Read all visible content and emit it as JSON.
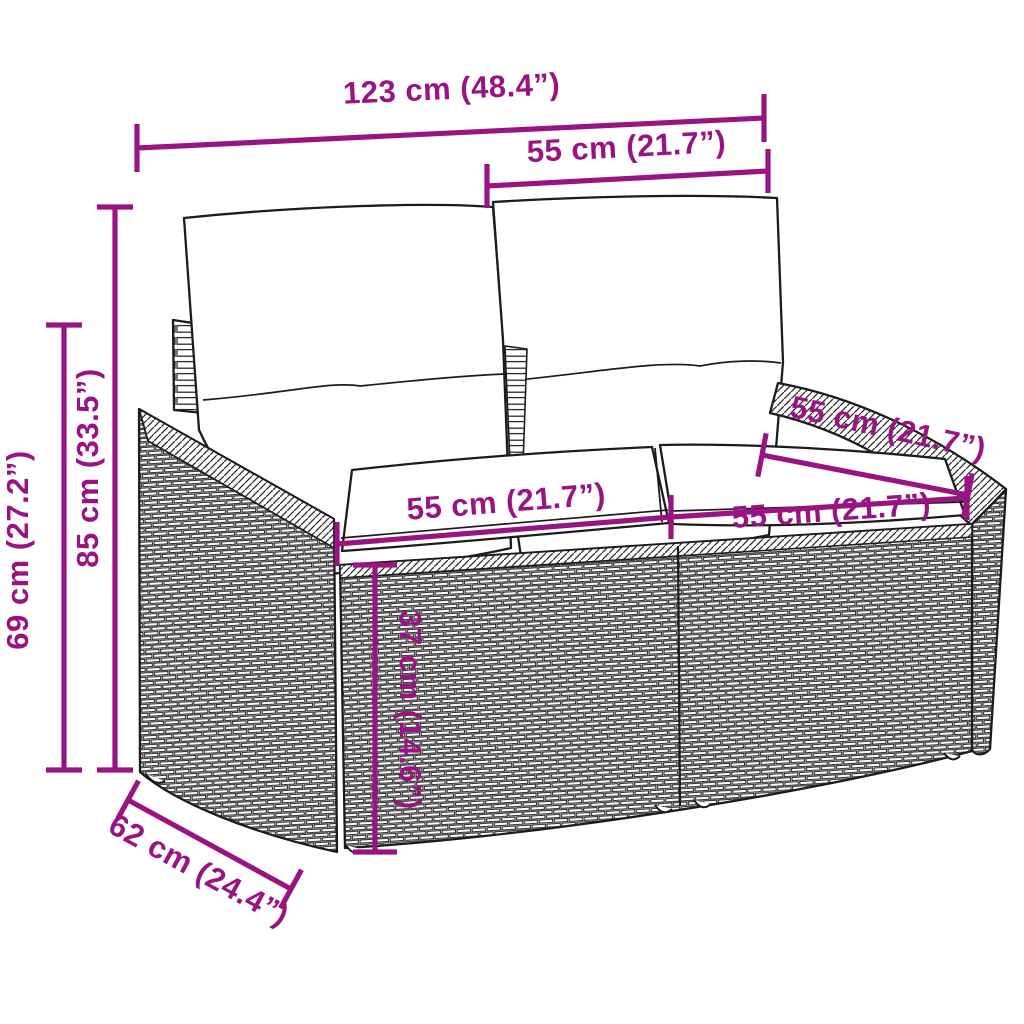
{
  "title": "Rattan garden sofa dimension diagram",
  "colors": {
    "dimension_accent": "#991482",
    "outline": "#1c1c1c",
    "background": "#ffffff"
  },
  "diagram": {
    "kind": "furniture-dimension-diagram",
    "subject": "poly rattan two-seater garden sofa with back and seat cushions",
    "dimensions": [
      {
        "id": "overall_width",
        "label": "123 cm (48.4”)"
      },
      {
        "id": "backrest_cushion_width",
        "label": "55 cm (21.7”)"
      },
      {
        "id": "overall_height",
        "label": "85 cm (33.5”)"
      },
      {
        "id": "armrest_height",
        "label": "69 cm (27.2”)"
      },
      {
        "id": "seat_width_left",
        "label": "55 cm (21.7”)"
      },
      {
        "id": "seat_width_right",
        "label": "55 cm (21.7”)"
      },
      {
        "id": "seat_depth_top_of_arm",
        "label": "55 cm (21.7”)"
      },
      {
        "id": "seat_height",
        "label": "37 cm (14.6”)"
      },
      {
        "id": "overall_depth",
        "label": "62 cm (24.4”)"
      }
    ]
  }
}
